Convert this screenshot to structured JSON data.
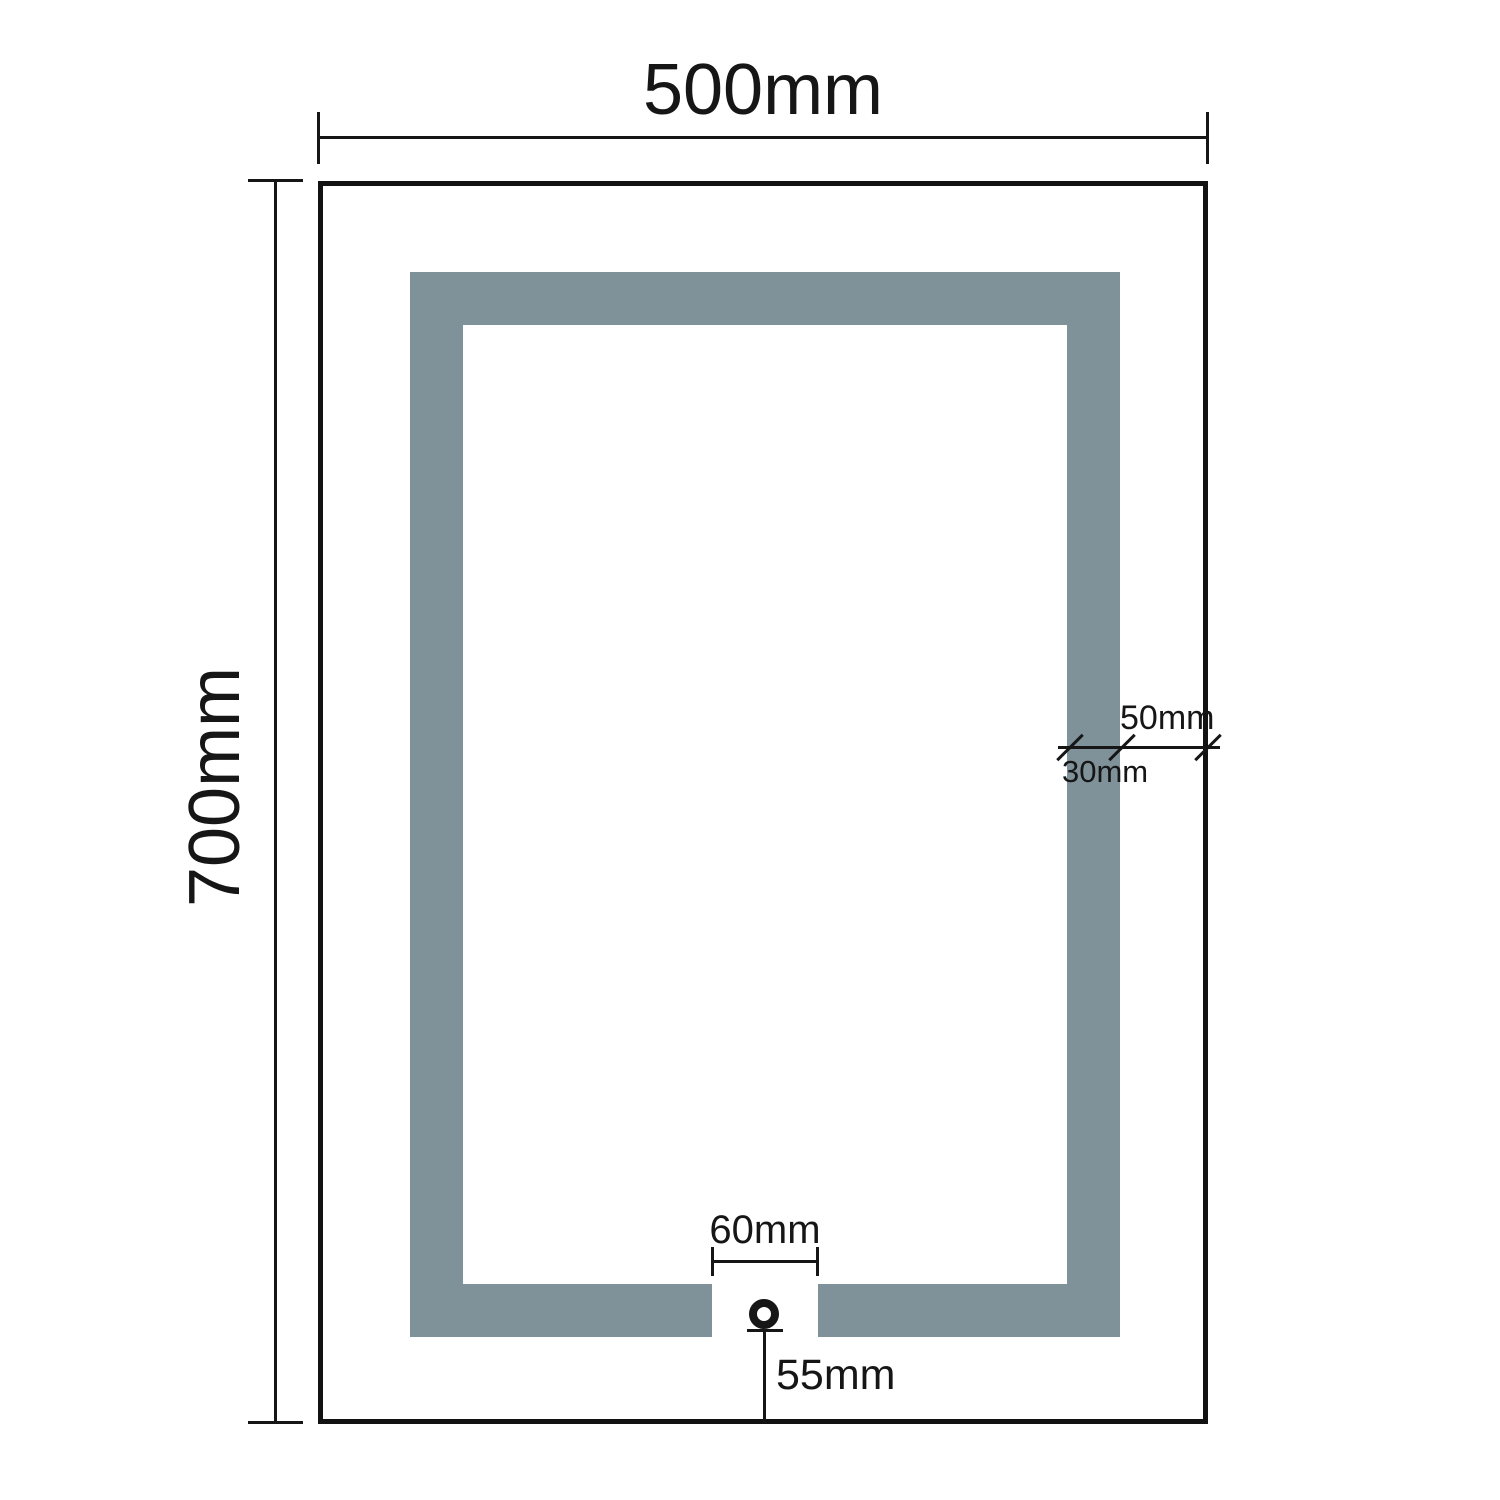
{
  "drawing": {
    "title": "mirror-dimension-diagram",
    "labels": {
      "width": "500mm",
      "height": "700mm",
      "band_edge_offset": "50mm",
      "band_thickness": "30mm",
      "gap_width": "60mm",
      "sensor_to_edge": "55mm"
    },
    "values_mm": {
      "width": 500,
      "height": 700,
      "band_edge_offset": 50,
      "band_thickness": 30,
      "gap_width": 60,
      "sensor_to_edge": 55
    },
    "colors": {
      "band": "#7F929A",
      "line": "#161616",
      "background": "#FFFFFF"
    },
    "sensor": {
      "symbol": "circle"
    }
  }
}
